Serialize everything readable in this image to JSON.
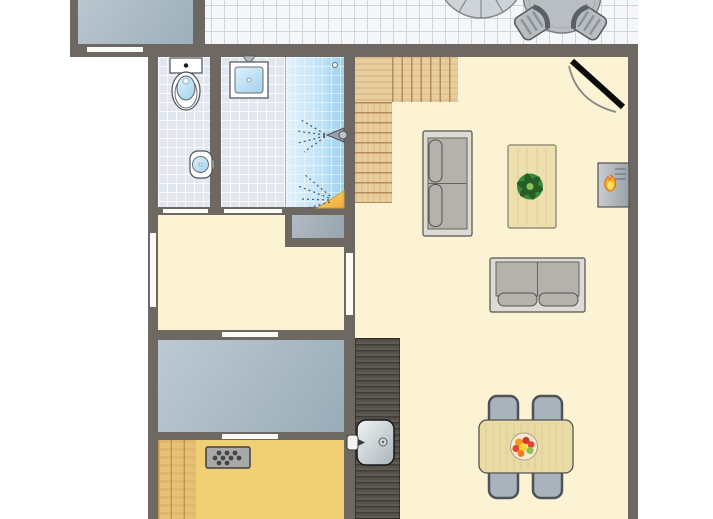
{
  "palette": {
    "wall": "#6e6863",
    "cream": "#fcf2d4",
    "sauna": "#f1cf74",
    "terrace_tile": "#f5f6f9",
    "terrace_line": "#cfd4dd",
    "bath_tile": "#e2e6ef",
    "shower_from": "#e4f2fb",
    "shower_to": "#9ed2ef",
    "wood": "#e9cd9d",
    "wood_line": "#b38c57",
    "bench": "#e9c176",
    "bench_line": "#c2964e",
    "counter": "#57514b",
    "bedroom_from": "#bcc9d3",
    "bedroom_to": "#9aacb8",
    "storage_from": "#b9c6cf",
    "storage_to": "#9dafbb",
    "closet_from": "#b0bbc3",
    "closet_to": "#98a5ae",
    "flame": "#ffac1f",
    "tv_black": "#0b0b0b"
  },
  "plan": {
    "canvas": {
      "width": 713,
      "height": 519
    },
    "rooms": [
      {
        "name": "storage-room",
        "x": 78,
        "y": 0,
        "w": 115,
        "h": 44,
        "surface": "grad-storage"
      },
      {
        "name": "terrace",
        "x": 205,
        "y": 0,
        "w": 433,
        "h": 45,
        "surface": "tiles-terrace"
      },
      {
        "name": "wc-room",
        "x": 158,
        "y": 57,
        "w": 52,
        "h": 150,
        "surface": "tiles-bath"
      },
      {
        "name": "bathroom",
        "x": 221,
        "y": 57,
        "w": 64,
        "h": 150,
        "surface": "tiles-bath"
      },
      {
        "name": "shower-cabin",
        "x": 285,
        "y": 57,
        "w": 59,
        "h": 150,
        "surface": "shower-bg"
      },
      {
        "name": "living-room",
        "x": 344,
        "y": 57,
        "w": 284,
        "h": 462,
        "surface": "floor-cream"
      },
      {
        "name": "hallway",
        "x": 158,
        "y": 215,
        "w": 186,
        "h": 115,
        "surface": "floor-cream"
      },
      {
        "name": "bedroom",
        "x": 158,
        "y": 340,
        "w": 186,
        "h": 92,
        "surface": "grad-bedroom"
      },
      {
        "name": "sauna",
        "x": 158,
        "y": 440,
        "w": 186,
        "h": 79,
        "surface": "floor-sauna"
      },
      {
        "name": "closet-niche",
        "x": 292,
        "y": 215,
        "w": 52,
        "h": 23,
        "surface": "grad-closet",
        "layer": 2
      },
      {
        "name": "stairs-landing",
        "x": 355,
        "y": 57,
        "w": 37,
        "h": 45,
        "surface": "wood-plain",
        "layer": 2
      },
      {
        "name": "stairs-upper-run",
        "x": 392,
        "y": 57,
        "w": 66,
        "h": 45,
        "surface": "wood-treads-v",
        "layer": 2
      },
      {
        "name": "stairs-lower-run",
        "x": 355,
        "y": 102,
        "w": 37,
        "h": 101,
        "surface": "wood-treads-h",
        "layer": 2
      },
      {
        "name": "kitchen-counter",
        "x": 355,
        "y": 338,
        "w": 45,
        "h": 181,
        "surface": "counter-dark",
        "layer": 2
      },
      {
        "name": "sauna-bench",
        "x": 158,
        "y": 440,
        "w": 38,
        "h": 79,
        "surface": "bench-wood",
        "layer": 2
      }
    ],
    "walls": [
      {
        "name": "wall-north",
        "x": 70,
        "y": 44,
        "w": 568,
        "h": 13
      },
      {
        "name": "wall-west",
        "x": 148,
        "y": 44,
        "w": 10,
        "h": 475
      },
      {
        "name": "wall-east",
        "x": 628,
        "y": 44,
        "w": 10,
        "h": 475
      },
      {
        "name": "wall-storage-left",
        "x": 70,
        "y": 0,
        "w": 8,
        "h": 48
      },
      {
        "name": "wall-storage-right",
        "x": 193,
        "y": 0,
        "w": 12,
        "h": 48
      },
      {
        "name": "wall-core-vertical",
        "x": 344,
        "y": 57,
        "w": 11,
        "h": 462
      },
      {
        "name": "wall-wc-bathroom",
        "x": 210,
        "y": 57,
        "w": 11,
        "h": 150
      },
      {
        "name": "wall-bath-south",
        "x": 158,
        "y": 207,
        "w": 186,
        "h": 8
      },
      {
        "name": "wall-closet-west",
        "x": 285,
        "y": 207,
        "w": 7,
        "h": 40
      },
      {
        "name": "wall-closet-south",
        "x": 285,
        "y": 238,
        "w": 59,
        "h": 9
      },
      {
        "name": "wall-hall-south",
        "x": 158,
        "y": 330,
        "w": 186,
        "h": 10
      },
      {
        "name": "wall-bedroom-south",
        "x": 158,
        "y": 432,
        "w": 186,
        "h": 8
      }
    ],
    "openings": [
      {
        "name": "window-storage",
        "x": 87,
        "y": 47,
        "w": 56,
        "h": 5
      },
      {
        "name": "door-wc",
        "x": 163,
        "y": 209,
        "w": 45,
        "h": 4
      },
      {
        "name": "door-bathroom",
        "x": 224,
        "y": 209,
        "w": 58,
        "h": 4
      },
      {
        "name": "window-hall-west",
        "x": 150,
        "y": 233,
        "w": 6,
        "h": 74
      },
      {
        "name": "door-hall-living",
        "x": 346,
        "y": 253,
        "w": 7,
        "h": 62
      },
      {
        "name": "door-hall-bedroom",
        "x": 222,
        "y": 332,
        "w": 56,
        "h": 5
      },
      {
        "name": "door-bedroom-sauna",
        "x": 222,
        "y": 434,
        "w": 56,
        "h": 5
      }
    ],
    "furniture": [
      {
        "name": "parasol",
        "type": "parasol",
        "x": 481,
        "y": -26
      },
      {
        "name": "patio-table",
        "type": "round-table",
        "x": 562,
        "y": -6,
        "r": 39
      },
      {
        "name": "patio-chair-left",
        "type": "patio-chair",
        "x": 532,
        "y": 23,
        "rot": -33
      },
      {
        "name": "patio-chair-right",
        "type": "patio-chair",
        "x": 589,
        "y": 23,
        "rot": -33,
        "flip": true
      },
      {
        "name": "tv",
        "type": "tv",
        "x": 568,
        "y": 58
      },
      {
        "name": "toilet",
        "type": "toilet",
        "x": 170,
        "y": 58
      },
      {
        "name": "washbasin",
        "type": "washbasin",
        "x": 230,
        "y": 56
      },
      {
        "name": "hand-basin",
        "type": "hand-basin",
        "x": 190,
        "y": 151
      },
      {
        "name": "shower-fittings",
        "type": "shower-fx",
        "x": 285,
        "y": 57
      },
      {
        "name": "sofa-left",
        "type": "sofa",
        "x": 423,
        "y": 131,
        "w": 49,
        "h": 105,
        "back": "left"
      },
      {
        "name": "coffee-table",
        "type": "coffee-table",
        "x": 508,
        "y": 145,
        "w": 48,
        "h": 83
      },
      {
        "name": "fireplace",
        "type": "fireplace",
        "x": 598,
        "y": 163
      },
      {
        "name": "sofa-bottom",
        "type": "sofa",
        "x": 490,
        "y": 258,
        "w": 95,
        "h": 54,
        "back": "top"
      },
      {
        "name": "dining-chair-1",
        "type": "dining-chair",
        "x": 489,
        "y": 396,
        "w": 29,
        "h": 44
      },
      {
        "name": "dining-chair-2",
        "type": "dining-chair",
        "x": 533,
        "y": 396,
        "w": 29,
        "h": 44
      },
      {
        "name": "dining-chair-3",
        "type": "dining-chair",
        "x": 489,
        "y": 453,
        "w": 29,
        "h": 45
      },
      {
        "name": "dining-chair-4",
        "type": "dining-chair",
        "x": 533,
        "y": 453,
        "w": 29,
        "h": 45
      },
      {
        "name": "dining-table",
        "type": "dining-table",
        "x": 479,
        "y": 420,
        "w": 94,
        "h": 53
      },
      {
        "name": "kitchen-sink",
        "type": "kitchen-sink",
        "x": 357,
        "y": 420
      },
      {
        "name": "sauna-heater",
        "type": "sauna-heater",
        "x": 206,
        "y": 447
      }
    ]
  }
}
